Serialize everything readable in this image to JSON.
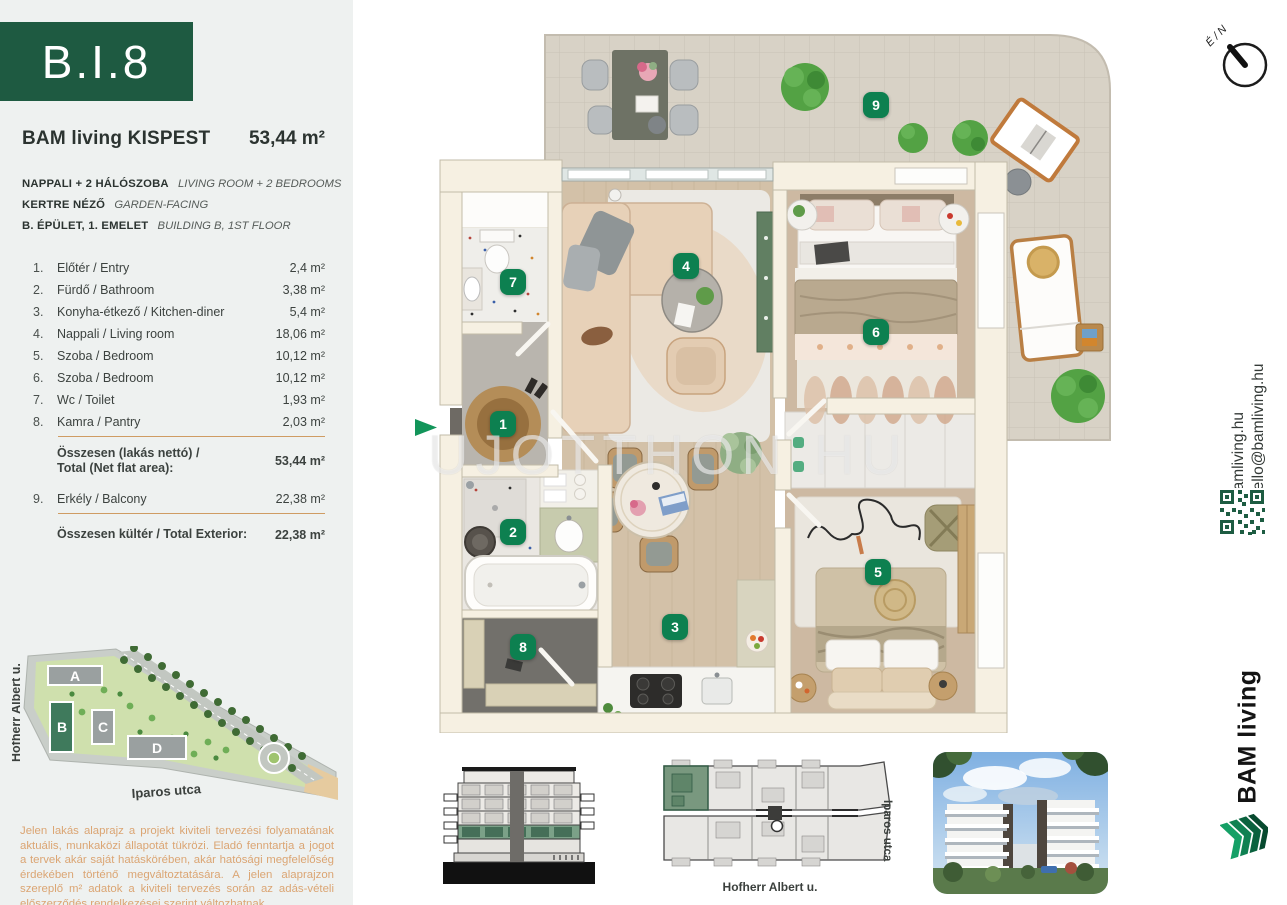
{
  "unit": {
    "code": "B.I.8",
    "project": "BAM living KISPEST",
    "total_area": "53,44 m²"
  },
  "subtitles": [
    {
      "hu": "NAPPALI + 2 HÁLÓSZOBA",
      "en": "LIVING ROOM + 2 BEDROOMS"
    },
    {
      "hu": "KERTRE NÉZŐ",
      "en": "GARDEN-FACING"
    },
    {
      "hu": "B. ÉPÜLET, 1. EMELET",
      "en": "BUILDING B, 1ST FLOOR"
    }
  ],
  "rooms": [
    {
      "no": "1.",
      "name": "Előtér / Entry",
      "area": "2,4 m²"
    },
    {
      "no": "2.",
      "name": "Fürdő / Bathroom",
      "area": "3,38 m²"
    },
    {
      "no": "3.",
      "name": "Konyha-étkező / Kitchen-diner",
      "area": "5,4 m²"
    },
    {
      "no": "4.",
      "name": "Nappali / Living room",
      "area": "18,06 m²"
    },
    {
      "no": "5.",
      "name": "Szoba / Bedroom",
      "area": "10,12 m²"
    },
    {
      "no": "6.",
      "name": "Szoba / Bedroom",
      "area": "10,12 m²"
    },
    {
      "no": "7.",
      "name": "Wc / Toilet",
      "area": "1,93 m²"
    },
    {
      "no": "8.",
      "name": "Kamra / Pantry",
      "area": "2,03 m²"
    },
    {
      "no": "9.",
      "name": "Erkély / Balcony",
      "area": "22,38 m²"
    }
  ],
  "totals": {
    "net_label_1": "Összesen (lakás nettó) /",
    "net_label_2": "Total (Net flat area):",
    "net_value": "53,44 m²",
    "exterior_label": "Összesen kültér / Total Exterior:",
    "exterior_value": "22,38 m²"
  },
  "plan": {
    "badges": [
      "1",
      "2",
      "3",
      "4",
      "5",
      "6",
      "7",
      "8",
      "9"
    ],
    "watermark_1": "UJOTTHON",
    "watermark_2": "HU",
    "compass_label": "É / N"
  },
  "site_map": {
    "buildings": [
      "A",
      "B",
      "C",
      "D"
    ],
    "street_left": "Hofherr Albert u.",
    "street_bottom": "Iparos utca"
  },
  "overview": {
    "street_bottom": "Hofherr Albert u.",
    "street_right": "Iparos utca"
  },
  "sidebar": {
    "website": "bamliving.hu",
    "email": "hello@bamliving.hu",
    "brand": "BAM living"
  },
  "disclaimer": "Jelen lakás alaprajz a projekt kiviteli tervezési folyamatának aktuális, munkaközi állapotát tükrözi. Eladó fenntartja a jogot a tervek akár saját hatáskörében, akár hatósági megfelelőség érdekében történő megváltoztatására. A jelen alaprajzon szereplő m² adatok a kiviteli tervezés során az adás-vételi előszerződés rendelkezései szerint változhatnak.",
  "colors": {
    "brand_green": "#1e5a41",
    "badge_green": "#0d8050",
    "accent_orange": "#cf9c63",
    "disclaimer_orange": "#dba573",
    "wall_cream": "#f6f0e2"
  }
}
